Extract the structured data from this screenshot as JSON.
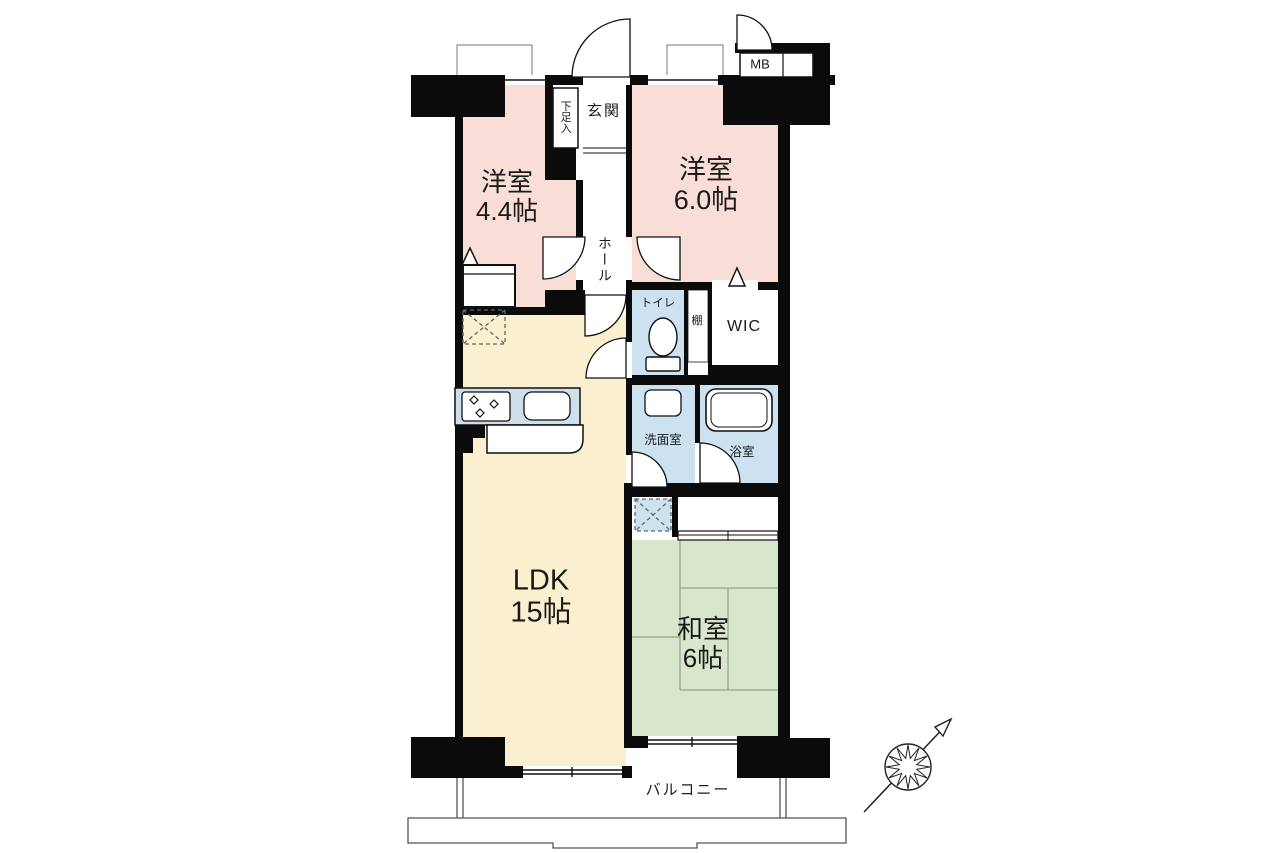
{
  "floorplan": {
    "rooms": {
      "western_room_1": {
        "name": "洋室",
        "size": "4.4帖"
      },
      "western_room_2": {
        "name": "洋室",
        "size": "6.0帖"
      },
      "ldk": {
        "name": "LDK",
        "size": "15帖"
      },
      "japanese_room": {
        "name": "和室",
        "size": "6帖"
      },
      "entrance": {
        "label": "玄関"
      },
      "shoe_cabinet": {
        "label": "下足入"
      },
      "hall": {
        "label": "ホール"
      },
      "meter_box": {
        "label": "MB"
      },
      "toilet": {
        "label": "トイレ"
      },
      "shelf": {
        "label": "棚"
      },
      "walk_in_closet": {
        "label": "WIC"
      },
      "washroom": {
        "label": "洗面室"
      },
      "bathroom": {
        "label": "浴室"
      },
      "balcony": {
        "label": "バルコニー"
      }
    },
    "colors": {
      "western_room": "#f9ded7",
      "ldk": "#faefce",
      "japanese_room": "#d8e6cb",
      "wet_area": "#cde2f1",
      "kitchen_counter": "#ccdfea",
      "tatami_line": "#8fa583",
      "wall": "#0b0b0b"
    }
  }
}
